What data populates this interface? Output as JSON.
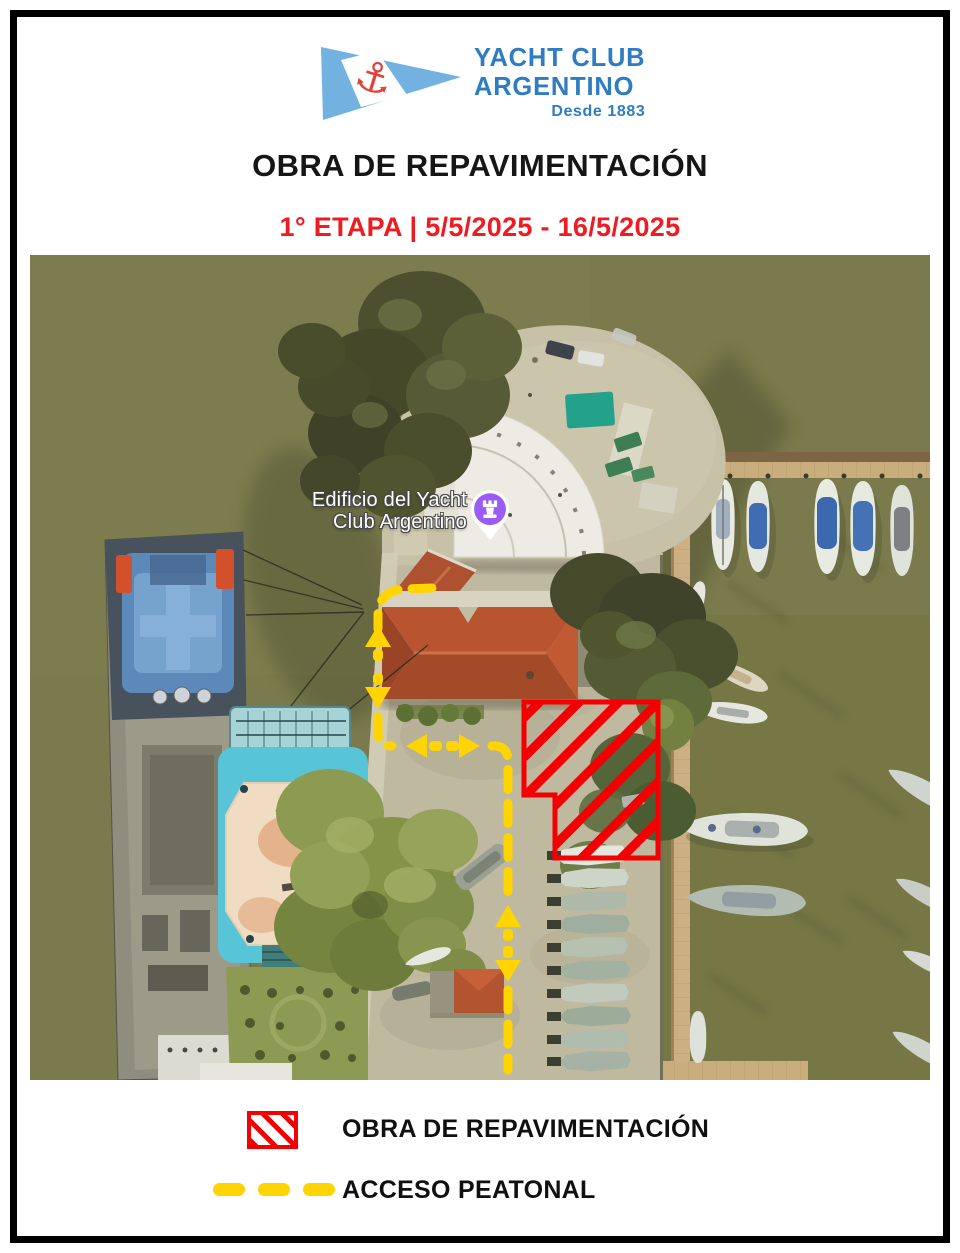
{
  "logo": {
    "name_line1": "YACHT CLUB",
    "name_line2": "ARGENTINO",
    "tagline": "Desde 1883"
  },
  "header": {
    "title": "OBRA DE REPAVIMENTACIÓN",
    "stage_line": "1° ETAPA | 5/5/2025 - 16/5/2025"
  },
  "map": {
    "poi_label_line1": "Edificio del Yacht",
    "poi_label_line2": "Club Argentino",
    "poi_pin": "purple-rook-landmark-pin"
  },
  "legend": {
    "items": [
      {
        "swatch": "red-diagonal-hatch",
        "label": "OBRA DE REPAVIMENTACIÓN"
      },
      {
        "swatch": "yellow-dashed-line",
        "label": "ACCESO PEATONAL"
      }
    ]
  },
  "colors": {
    "accent_red": "#f50002",
    "path_yellow": "#ffd400",
    "logo_blue": "#2e7cc1",
    "subtitle_red": "#ee1b22",
    "pin_purple": "#9a5cf5",
    "water_olive": "#78784a"
  }
}
